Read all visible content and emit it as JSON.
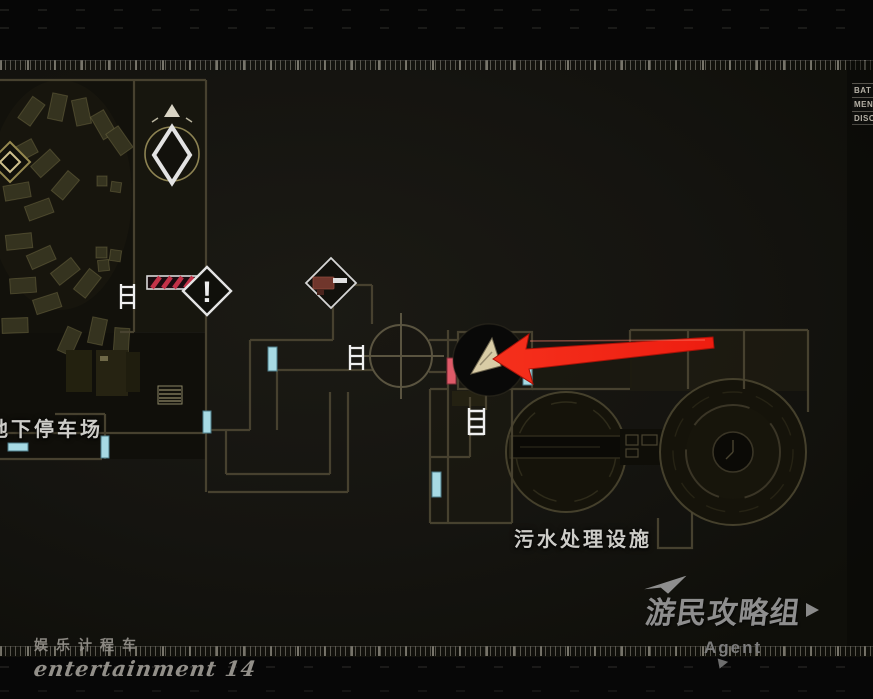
{
  "window": {
    "type": "game-map-screen"
  },
  "hud": {
    "menu_rows": [
      {
        "label": "BAT"
      },
      {
        "label": "MEN"
      },
      {
        "label": "DISC"
      }
    ]
  },
  "map": {
    "area_labels": {
      "parking": "地下停车场",
      "sewage": "污水处理设施"
    },
    "alert_glyph": "!",
    "icons": [
      "save-point-icon",
      "north-arrow-icon",
      "poi-diamond-icon",
      "alert-diamond-icon",
      "weapon-item-icon",
      "barrier-icon",
      "ladder-icon",
      "player-marker-icon",
      "guide-arrow-icon",
      "door-marker-cyan",
      "door-marker-red"
    ],
    "colors": {
      "guide_arrow": "#f22718",
      "door_cyan": "#a7dae4",
      "door_red": "#df5a68",
      "player_marker": "#d9cca6",
      "wall": "#4a4431",
      "label_text": "#cdccc8"
    }
  },
  "watermarks": {
    "bottom_left": {
      "line1": "娱乐计程车",
      "line2": "entertainment 14"
    },
    "bottom_right": {
      "logo_text": "游民攻略组",
      "sub_text": "Agent"
    }
  }
}
